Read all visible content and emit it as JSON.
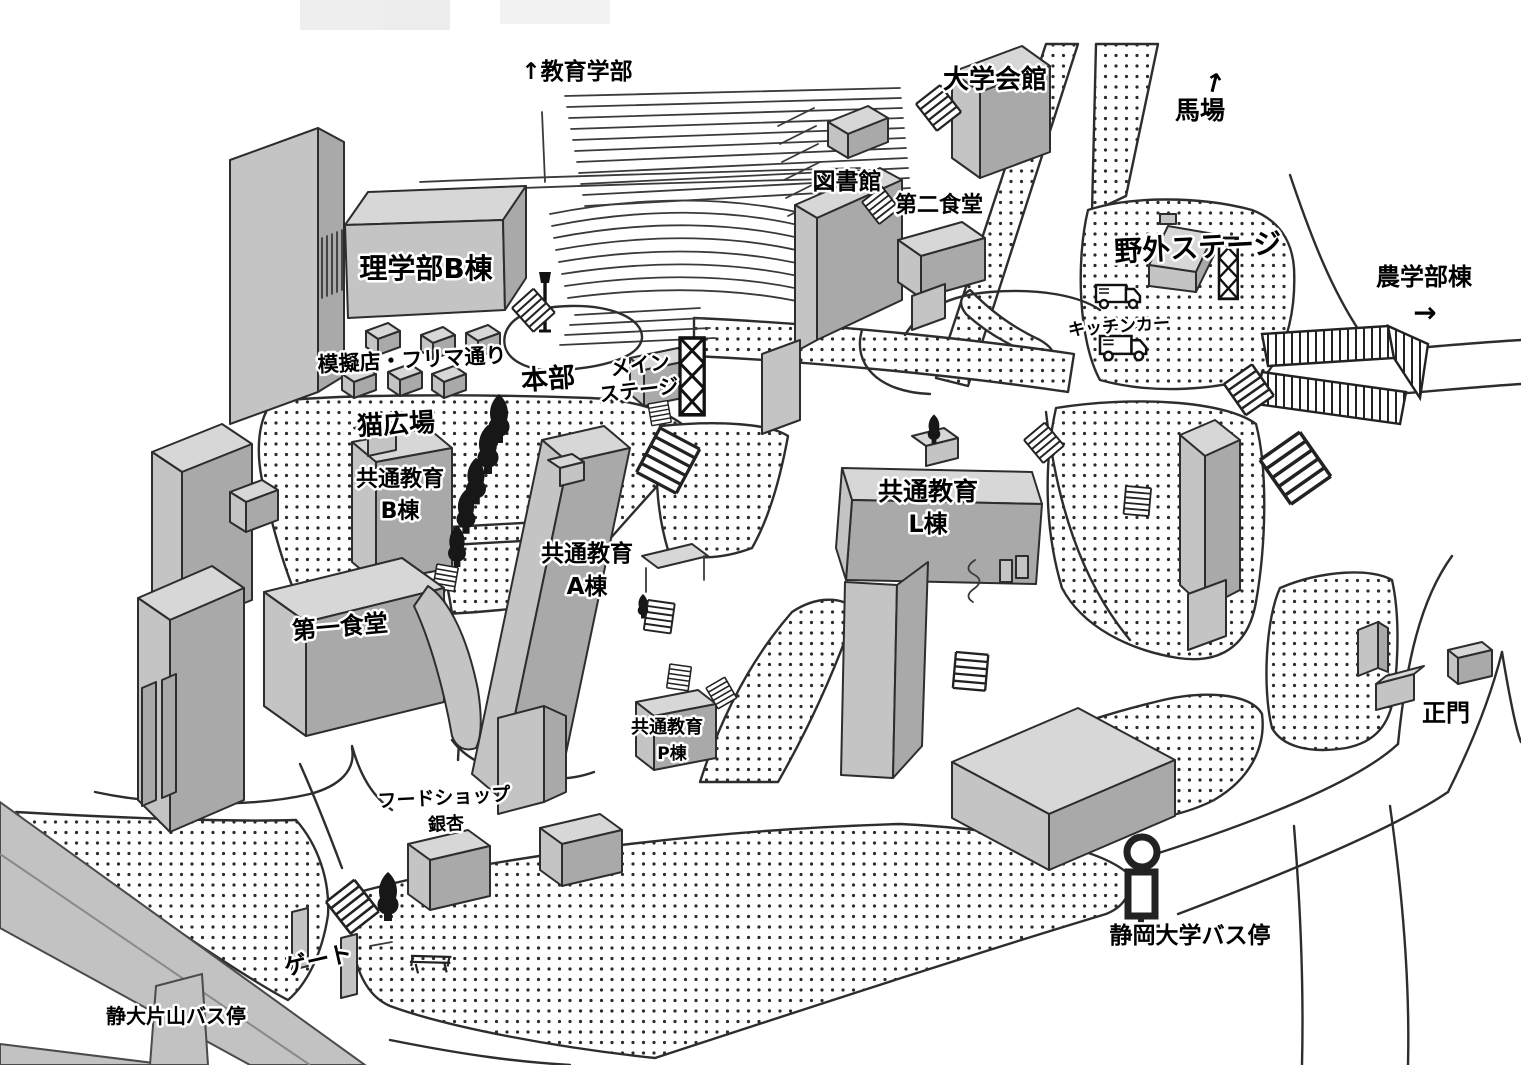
{
  "map": {
    "type": "illustrated-campus-map",
    "labels": {
      "education_faculty": "↑教育学部",
      "university_hall": "大学会館",
      "horse_ground_arrow": "↑",
      "horse_ground": "馬場",
      "library": "図書館",
      "second_cafeteria": "第二食堂",
      "science_bldg_b": "理学部B棟",
      "outdoor_stage": "野外ステージ",
      "agriculture_bldg": "農学部棟",
      "agriculture_arrow": "→",
      "kitchen_car": "キッチンカー",
      "mock_shop_street": "模擬店・フリマ通り",
      "headquarters": "本部",
      "main_stage_line1": "メイン",
      "main_stage_line2": "ステージ",
      "cat_plaza": "猫広場",
      "common_ed_b_line1": "共通教育",
      "common_ed_b_line2": "B棟",
      "common_ed_a_line1": "共通教育",
      "common_ed_a_line2": "A棟",
      "common_ed_l_line1": "共通教育",
      "common_ed_l_line2": "L棟",
      "first_cafeteria": "第一食堂",
      "common_ed_p_line1": "共通教育",
      "common_ed_p_line2": "P棟",
      "food_shop_line1": "フードショップ",
      "food_shop_line2": "銀杏",
      "gate": "ゲート",
      "katayama_bus_stop": "静大片山バス停",
      "univ_bus_stop": "静岡大学バス停",
      "main_gate": "正門"
    },
    "icons": {
      "bus_stop_sign": "pole with circle sign and panel",
      "kitchen_truck": "food truck",
      "tree": "dark evergreen tree",
      "stairs": "staircase steps",
      "stage_truss": "lattice truss tower",
      "street_lamp": "lamp post",
      "bench": "bench"
    },
    "colors": {
      "background": "#ffffff",
      "outline": "#2d2d2d",
      "building_top": "#d7d7d7",
      "building_front": "#c4c4c4",
      "building_side": "#a9a9a9",
      "road": "#c2c2c2",
      "stipple_dot": "#2b2b2b",
      "tree": "#171717",
      "label_text": "#000000",
      "label_halo": "#ffffff"
    }
  }
}
